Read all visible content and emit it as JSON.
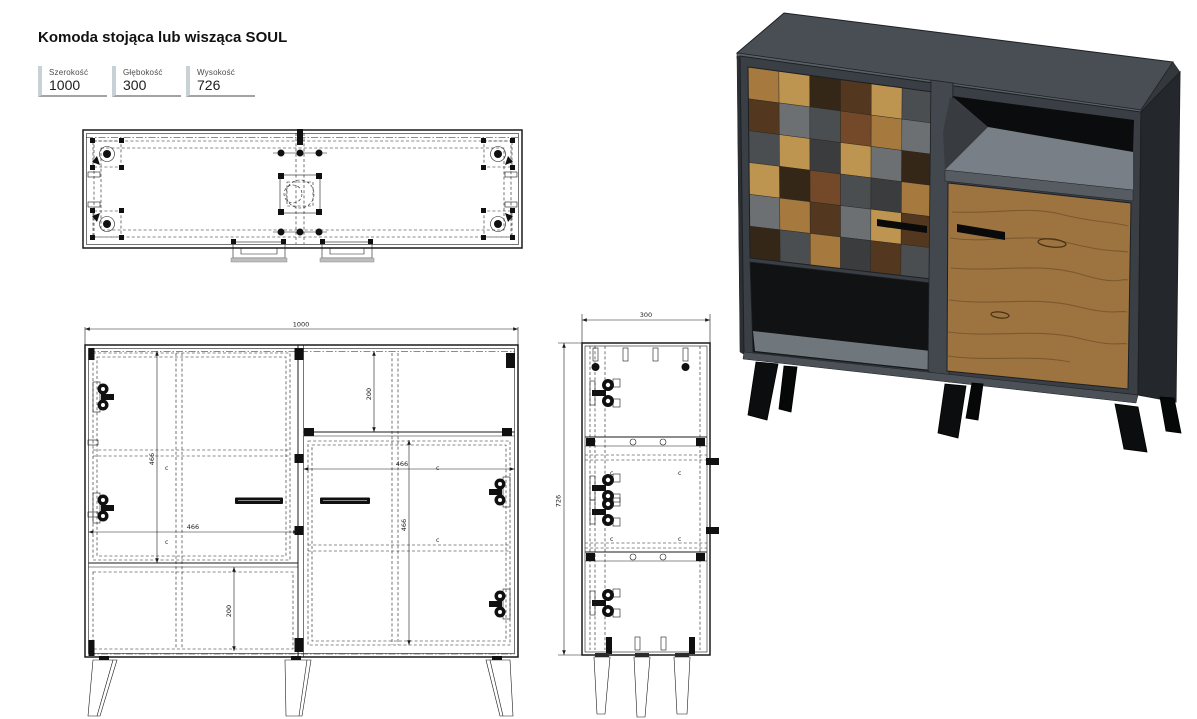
{
  "title": "Komoda stojąca lub wisząca SOUL",
  "spec_table": {
    "cells": [
      {
        "label": "Szerokość",
        "value": "1000"
      },
      {
        "label": "Głębokość",
        "value": "300"
      },
      {
        "label": "Wysokość",
        "value": "726"
      }
    ]
  },
  "front_view": {
    "dim_width": "1000",
    "dim_left_door_height": "466",
    "dim_left_door_width": "466",
    "dim_right_door_width": "466",
    "dim_right_door_height": "466",
    "dim_top_niche_height": "200",
    "dim_bottom_niche_height": "200",
    "marker": "c"
  },
  "side_view": {
    "dim_depth": "300",
    "dim_height": "726",
    "marker": "c"
  },
  "colors": {
    "accent_table_bar": "#c7d1d6",
    "drawing_line": "#1b1b1b",
    "body_front": "#3a3f45",
    "body_side": "#24272b",
    "body_top": "#484e53",
    "shelf_gray": "#787f86",
    "oak": "#9d7440",
    "oak_dark": "#5d3f22",
    "niche_black": "#0b0c0d",
    "leg_black": "#0c0d0e"
  },
  "render3d": {
    "checker_palette": {
      "o1": "#a67a3e",
      "o2": "#bd9450",
      "d1": "#53381f",
      "d2": "#352718",
      "g1": "#6c7072",
      "g2": "#4b4e50",
      "r1": "#74492a",
      "c1": "#3b3c3e"
    },
    "checker_grid": [
      [
        "o1",
        "o2",
        "d2",
        "d1",
        "o2",
        "g2"
      ],
      [
        "d1",
        "g1",
        "g2",
        "r1",
        "o1",
        "g1"
      ],
      [
        "g2",
        "o2",
        "c1",
        "o2",
        "g1",
        "d2"
      ],
      [
        "o2",
        "d2",
        "r1",
        "g2",
        "c1",
        "o1"
      ],
      [
        "g1",
        "o1",
        "d1",
        "g1",
        "o2",
        "d1"
      ],
      [
        "d2",
        "g2",
        "o1",
        "c1",
        "d1",
        "g2"
      ]
    ]
  }
}
